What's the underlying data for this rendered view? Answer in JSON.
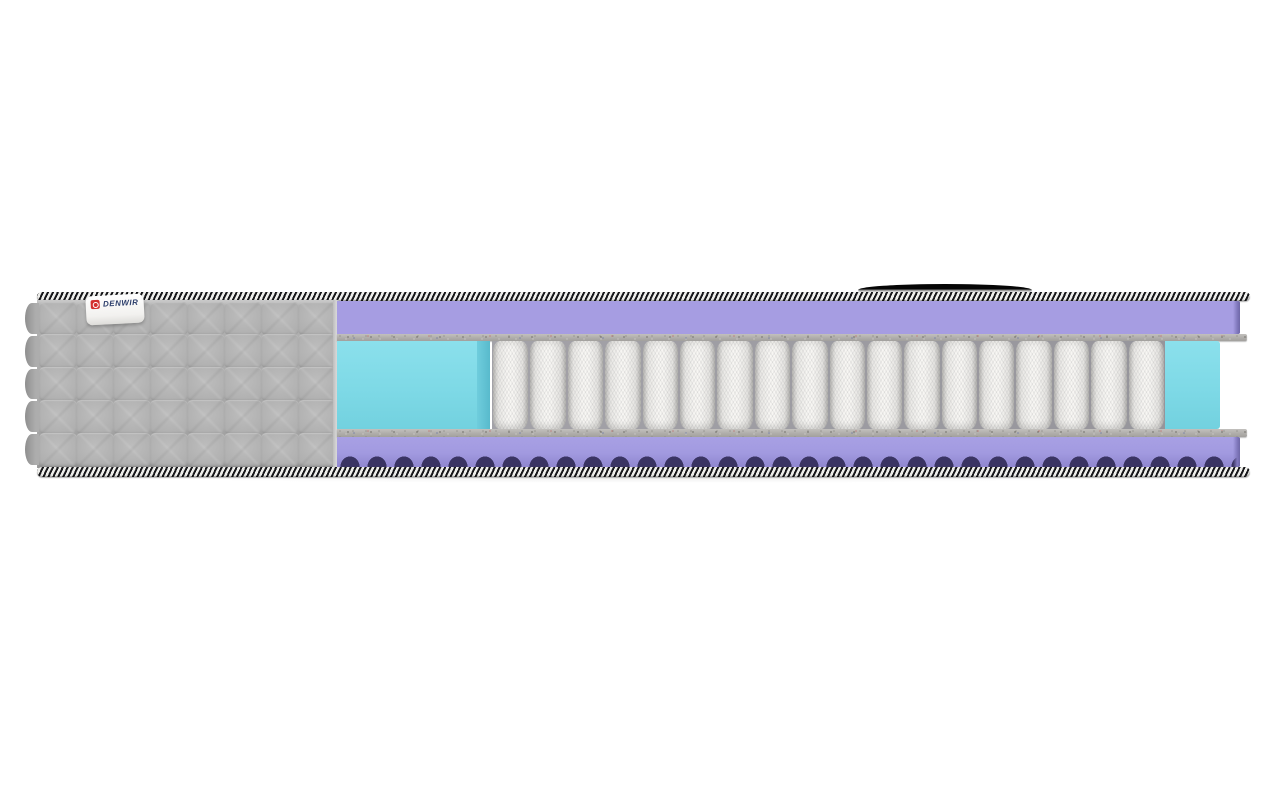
{
  "image": {
    "type": "product-render",
    "subject": "mattress-cross-section-side-view",
    "background_color": "#ffffff"
  },
  "brand_tag": {
    "text": "DENWIR",
    "tag_color": "#ffffff",
    "logo_color": "#d32f2f",
    "text_color": "#2c3e6b"
  },
  "handle": {
    "name": "carry-handle",
    "color": "#111111"
  },
  "layers": [
    {
      "name": "quilted-fabric-cover",
      "color": "#aaaaaa"
    },
    {
      "name": "binding-tape",
      "colors": [
        "#17171a",
        "#efefec"
      ]
    },
    {
      "name": "egg-crate-comfort-foam-top",
      "color": "#a69de2",
      "shadow_color": "#3a3463"
    },
    {
      "name": "felt-insulator-pad-top",
      "color": "#b4b2af"
    },
    {
      "name": "pocket-spring-block",
      "color": "#f1f0ee",
      "count": 18
    },
    {
      "name": "perimeter-support-foam",
      "color": "#7ed9e6"
    },
    {
      "name": "felt-insulator-pad-bottom",
      "color": "#b4b2af"
    },
    {
      "name": "egg-crate-comfort-foam-bottom",
      "color": "#a29ae0",
      "shadow_color": "#3a3463"
    }
  ],
  "structure": {
    "springs": 18,
    "quilt": {
      "rows": 5,
      "cols": 8
    },
    "scallops": 5
  }
}
